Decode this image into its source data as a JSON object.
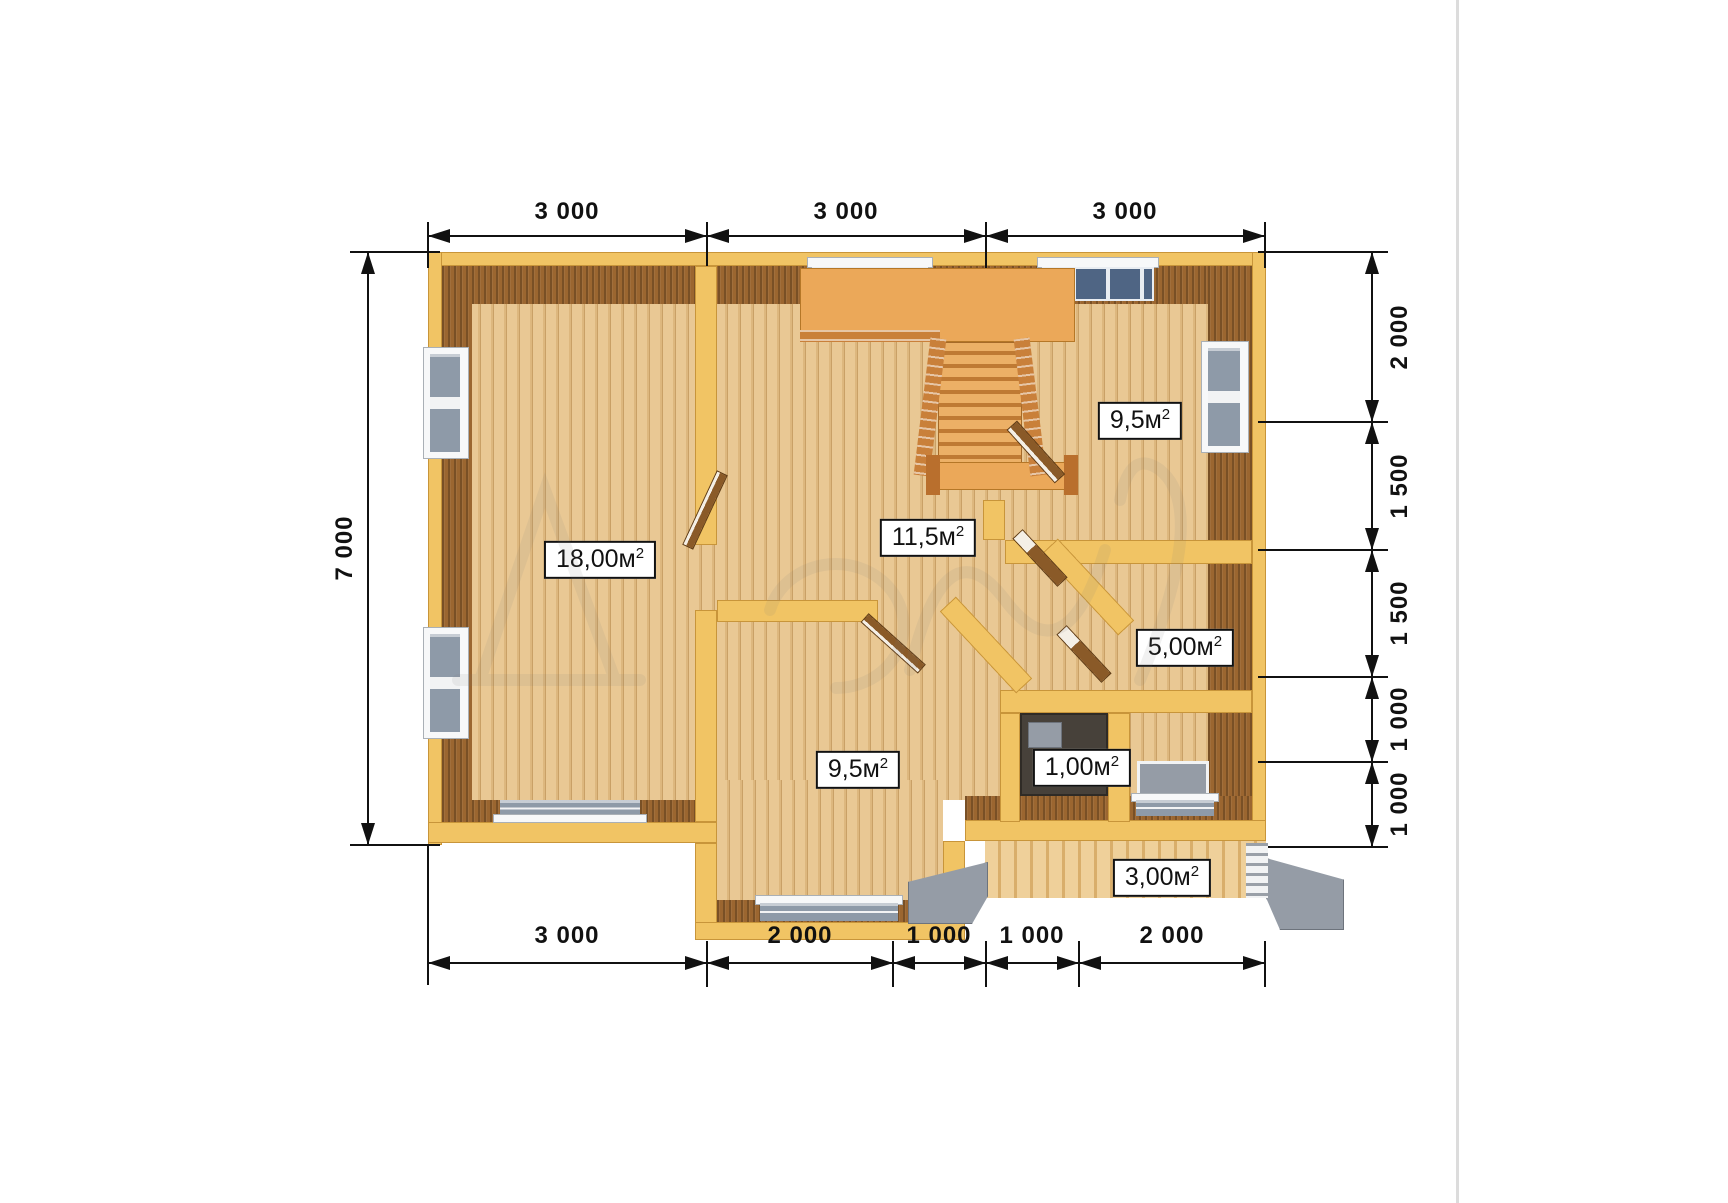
{
  "title": "Wooden house first-floor plan render",
  "dims": {
    "top": [
      "3 000",
      "3 000",
      "3 000"
    ],
    "bottom": [
      "3 000",
      "2 000",
      "1 000",
      "1 000",
      "2 000"
    ],
    "left": [
      "7 000"
    ],
    "right": [
      "2 000",
      "1 500",
      "1 500",
      "1 000",
      "1 000"
    ]
  },
  "rooms": [
    {
      "id": "living-room",
      "area": "18,00м",
      "exp": "2"
    },
    {
      "id": "hall",
      "area": "11,5м",
      "exp": "2"
    },
    {
      "id": "bedroom-right",
      "area": "9,5м",
      "exp": "2"
    },
    {
      "id": "bedroom-bottom",
      "area": "9,5м",
      "exp": "2"
    },
    {
      "id": "room-right-small",
      "area": "5,00м",
      "exp": "2"
    },
    {
      "id": "wc",
      "area": "1,00м",
      "exp": "2"
    },
    {
      "id": "porch",
      "area": "3,00м",
      "exp": "2"
    }
  ],
  "colors": {
    "wall_yellow": "#F1C464",
    "wall_face_brown": "#9B6630",
    "floor_wood": "#E4C189",
    "stair_orange": "#EBA859",
    "steps_gray": "#959CA6",
    "dimension_ink": "#111111"
  }
}
